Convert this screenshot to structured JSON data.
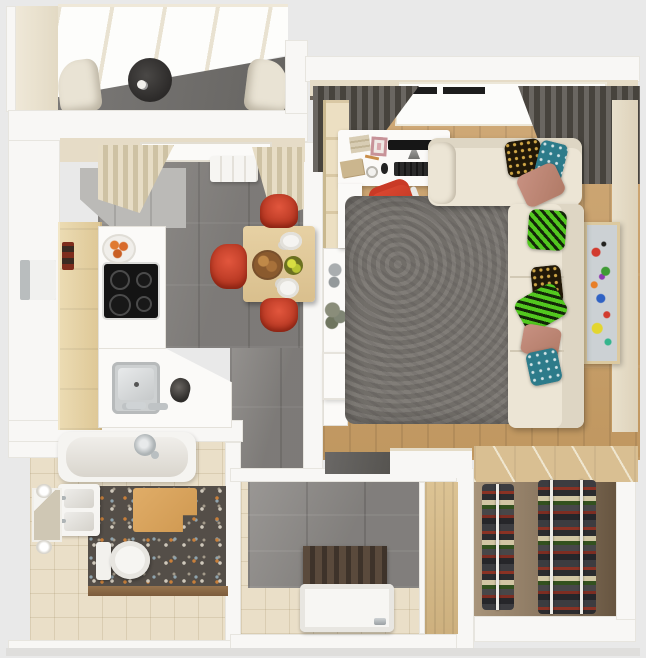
{
  "meta": {
    "title": "One-bedroom apartment - 3D top-down floor plan render",
    "view": "orthographic top view, no visible text in image"
  },
  "palette": {
    "background": "#e9e9e9",
    "wall_white": "#f8f7f5",
    "wall_beige": "#e6dcc7",
    "wood_floor": "#c9a26b",
    "wood_cabinet": "#e8d7ae",
    "closet_wood": "#d9bf92",
    "tile_gray": "#8b8885",
    "marble_tile": "#8e8b88",
    "rug_gray": "#7a7671",
    "sofa_cream": "#ece5d5",
    "accent_red": "#d6452f",
    "curtain_dark": "#55524e",
    "curtain_beige": "#e0d6bf",
    "terrazzo": "#544e48",
    "bath_tile": "#eadfc8",
    "mat_orange": "#d9a45f",
    "pillow_green": "#52c81f",
    "pillow_teal": "#2d7b8a",
    "pillow_gold_on_black": "#cfa646",
    "cooktop_black": "#141414"
  },
  "rooms": {
    "balcony": {
      "label": "Balcony with glazed roof",
      "furniture": [
        "glass roof panels",
        "two beige lounge chairs",
        "dark round side table with cup",
        "gray tile floor"
      ]
    },
    "kitchen": {
      "label": "Kitchen and dining area",
      "furniture": [
        "window with beige curtains",
        "radiator",
        "gray upper cabinets",
        "wood cabinet run",
        "fridge",
        "white counter with black induction cooktop",
        "bowl of oranges",
        "canisters",
        "gray pot",
        "stainless sink with faucet",
        "square wood dining table",
        "three red chairs",
        "plates, bread bowl, fruit bowl",
        "bar console with vases and plant"
      ]
    },
    "living": {
      "label": "Living room",
      "furniture": [
        "window with dark gray curtains",
        "white desk with monitor, keyboard, mouse, books, notebook, papers",
        "red swivel office chair",
        "wood wardrobe strip",
        "white console",
        "cream corner sofa",
        "patterned pillows (gold-on-black, teal, salmon, green zigzag)",
        "gray shag rug",
        "framed abstract painting",
        "oak plank floor"
      ]
    },
    "bathroom": {
      "label": "Bathroom",
      "furniture": [
        "bathtub with chrome shower head",
        "double washbasin vanity",
        "mirror with two sconces",
        "toilet",
        "orange bath mat",
        "terrazzo floor",
        "beige tile floor"
      ]
    },
    "shower_room": {
      "label": "Entry shower room",
      "furniture": [
        "marble tiled walls",
        "dark slatted panel",
        "white shower tray with drain",
        "wood door panel"
      ]
    },
    "closet": {
      "label": "Walk-in closet",
      "furniture": [
        "wood top shelf with rails",
        "two hanging clothes racks with chrome rails"
      ]
    },
    "corridor": {
      "label": "Corridor",
      "furniture": [
        "wood floor",
        "gray tile threshold",
        "white partition"
      ]
    }
  }
}
